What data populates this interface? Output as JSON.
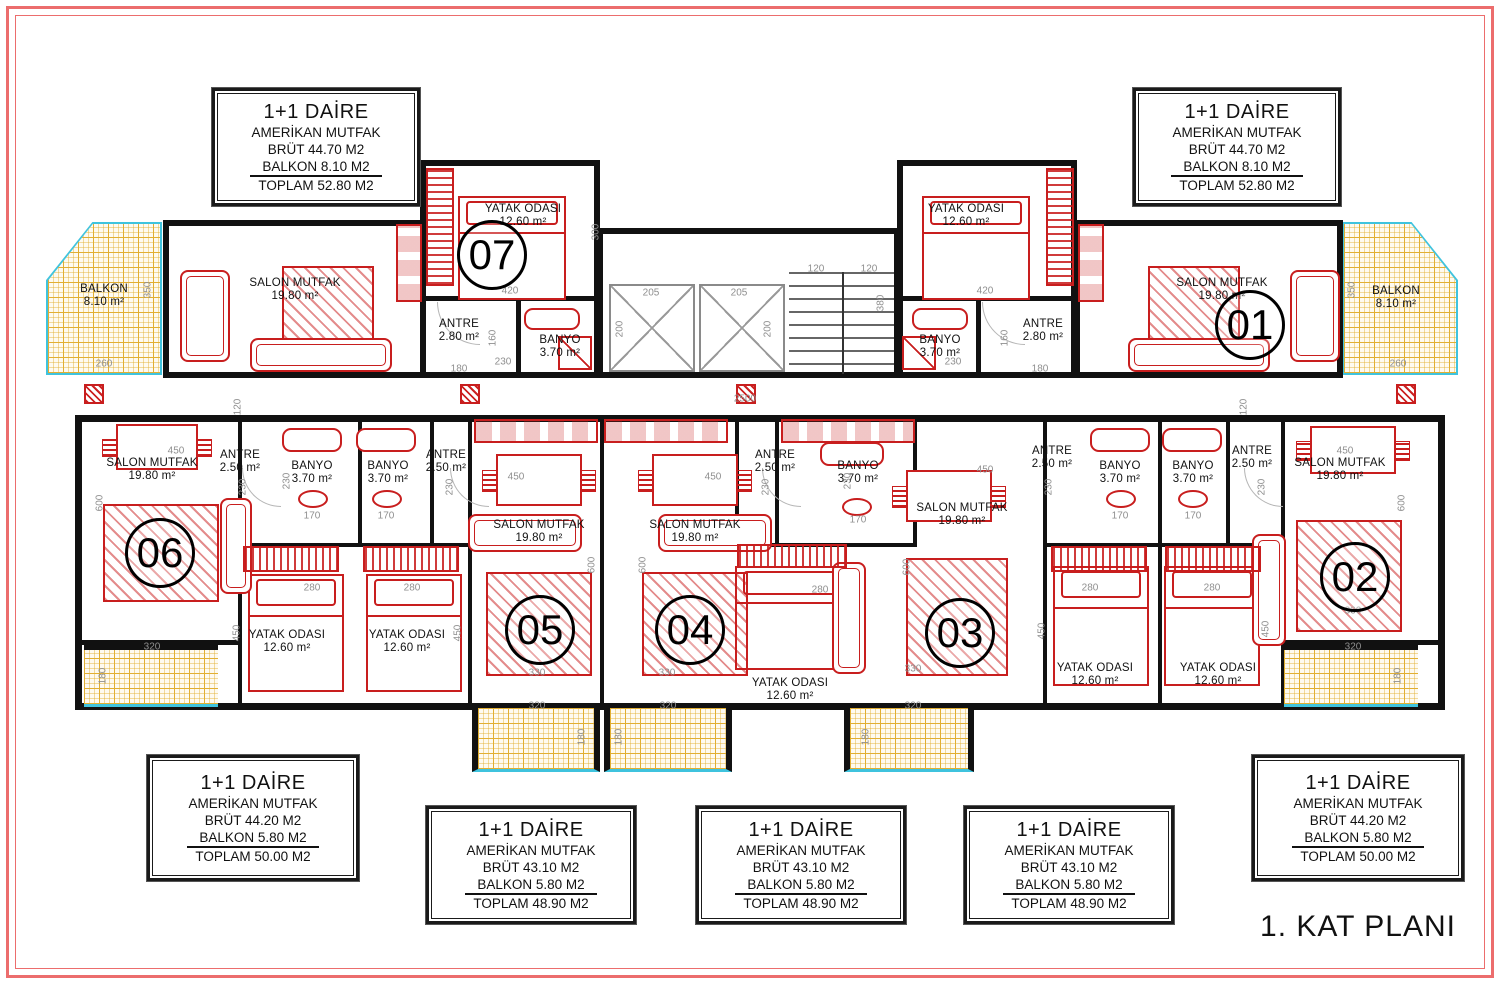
{
  "page": {
    "title": "1. KAT PLANI"
  },
  "colors": {
    "wall": "#111111",
    "furniture": "#c81e1e",
    "balcony_tile": "#e2b032",
    "balcony_edge": "#3fc3de",
    "dimension_text": "#8f8f8f",
    "frame": "#ec6d6d"
  },
  "units": [
    {
      "number": "01"
    },
    {
      "number": "02"
    },
    {
      "number": "03"
    },
    {
      "number": "04"
    },
    {
      "number": "05"
    },
    {
      "number": "06"
    },
    {
      "number": "07"
    }
  ],
  "info_boxes": [
    {
      "title": "1+1 DAİRE",
      "kitchen": "AMERİKAN MUTFAK",
      "brut": "BRÜT 44.70 M2",
      "balkon": "BALKON 8.10 M2",
      "toplam": "TOPLAM 52.80 M2"
    },
    {
      "title": "1+1 DAİRE",
      "kitchen": "AMERİKAN MUTFAK",
      "brut": "BRÜT 44.70 M2",
      "balkon": "BALKON 8.10 M2",
      "toplam": "TOPLAM 52.80 M2"
    },
    {
      "title": "1+1 DAİRE",
      "kitchen": "AMERİKAN MUTFAK",
      "brut": "BRÜT 44.20 M2",
      "balkon": "BALKON 5.80 M2",
      "toplam": "TOPLAM 50.00 M2"
    },
    {
      "title": "1+1 DAİRE",
      "kitchen": "AMERİKAN MUTFAK",
      "brut": "BRÜT 43.10 M2",
      "balkon": "BALKON 5.80 M2",
      "toplam": "TOPLAM 48.90 M2"
    },
    {
      "title": "1+1 DAİRE",
      "kitchen": "AMERİKAN MUTFAK",
      "brut": "BRÜT 43.10 M2",
      "balkon": "BALKON 5.80 M2",
      "toplam": "TOPLAM 48.90 M2"
    },
    {
      "title": "1+1 DAİRE",
      "kitchen": "AMERİKAN MUTFAK",
      "brut": "BRÜT 43.10 M2",
      "balkon": "BALKON 5.80 M2",
      "toplam": "TOPLAM 48.90 M2"
    },
    {
      "title": "1+1 DAİRE",
      "kitchen": "AMERİKAN MUTFAK",
      "brut": "BRÜT 44.20 M2",
      "balkon": "BALKON 5.80 M2",
      "toplam": "TOPLAM 50.00 M2"
    }
  ],
  "room_labels": [
    {
      "n": "BALKON",
      "a": "8.10 m²",
      "x": 104,
      "y": 296
    },
    {
      "n": "SALON MUTFAK",
      "a": "19.80 m²",
      "x": 295,
      "y": 290
    },
    {
      "n": "YATAK ODASI",
      "a": "12.60 m²",
      "x": 523,
      "y": 216
    },
    {
      "n": "ANTRE",
      "a": "2.80 m²",
      "x": 459,
      "y": 331
    },
    {
      "n": "BANYO",
      "a": "3.70 m²",
      "x": 560,
      "y": 347
    },
    {
      "n": "YATAK ODASI",
      "a": "12.60 m²",
      "x": 966,
      "y": 216
    },
    {
      "n": "BANYO",
      "a": "3.70 m²",
      "x": 940,
      "y": 347
    },
    {
      "n": "ANTRE",
      "a": "2.80 m²",
      "x": 1043,
      "y": 331
    },
    {
      "n": "SALON MUTFAK",
      "a": "19.80 m²",
      "x": 1222,
      "y": 290
    },
    {
      "n": "BALKON",
      "a": "8.10 m²",
      "x": 1396,
      "y": 298
    },
    {
      "n": "SALON MUTFAK",
      "a": "19.80 m²",
      "x": 152,
      "y": 470
    },
    {
      "n": "ANTRE",
      "a": "2.50 m²",
      "x": 240,
      "y": 462
    },
    {
      "n": "BANYO",
      "a": "3.70 m²",
      "x": 312,
      "y": 473
    },
    {
      "n": "BANYO",
      "a": "3.70 m²",
      "x": 388,
      "y": 473
    },
    {
      "n": "ANTRE",
      "a": "2.50 m²",
      "x": 446,
      "y": 462
    },
    {
      "n": "SALON MUTFAK",
      "a": "19.80 m²",
      "x": 539,
      "y": 532
    },
    {
      "n": "SALON MUTFAK",
      "a": "19.80 m²",
      "x": 695,
      "y": 532
    },
    {
      "n": "ANTRE",
      "a": "2.50 m²",
      "x": 775,
      "y": 462
    },
    {
      "n": "BANYO",
      "a": "3.70 m²",
      "x": 858,
      "y": 473
    },
    {
      "n": "SALON MUTFAK",
      "a": "19.80 m²",
      "x": 962,
      "y": 515
    },
    {
      "n": "ANTRE",
      "a": "2.50 m²",
      "x": 1052,
      "y": 458
    },
    {
      "n": "BANYO",
      "a": "3.70 m²",
      "x": 1120,
      "y": 473
    },
    {
      "n": "BANYO",
      "a": "3.70 m²",
      "x": 1193,
      "y": 473
    },
    {
      "n": "ANTRE",
      "a": "2.50 m²",
      "x": 1252,
      "y": 458
    },
    {
      "n": "SALON MUTFAK",
      "a": "19.80 m²",
      "x": 1340,
      "y": 470
    },
    {
      "n": "YATAK ODASI",
      "a": "12.60 m²",
      "x": 287,
      "y": 642
    },
    {
      "n": "YATAK ODASI",
      "a": "12.60 m²",
      "x": 407,
      "y": 642
    },
    {
      "n": "YATAK ODASI",
      "a": "12.60 m²",
      "x": 790,
      "y": 690
    },
    {
      "n": "YATAK ODASI",
      "a": "12.60 m²",
      "x": 1095,
      "y": 675
    },
    {
      "n": "YATAK ODASI",
      "a": "12.60 m²",
      "x": 1218,
      "y": 675
    }
  ],
  "dims": [
    [
      "350",
      148,
      290,
      1
    ],
    [
      "260",
      104,
      364,
      0
    ],
    [
      "300",
      596,
      232,
      1
    ],
    [
      "420",
      510,
      291,
      0
    ],
    [
      "160",
      493,
      338,
      1
    ],
    [
      "180",
      459,
      369,
      0
    ],
    [
      "230",
      503,
      362,
      0
    ],
    [
      "200",
      620,
      329,
      1
    ],
    [
      "205",
      651,
      293,
      0
    ],
    [
      "205",
      739,
      293,
      0
    ],
    [
      "200",
      768,
      329,
      1
    ],
    [
      "120",
      816,
      269,
      0
    ],
    [
      "120",
      869,
      269,
      0
    ],
    [
      "380",
      881,
      303,
      1
    ],
    [
      "420",
      985,
      291,
      0
    ],
    [
      "160",
      1005,
      338,
      1
    ],
    [
      "230",
      953,
      362,
      0
    ],
    [
      "180",
      1040,
      369,
      0
    ],
    [
      "350",
      1352,
      290,
      1
    ],
    [
      "260",
      1398,
      364,
      0
    ],
    [
      "2500",
      745,
      399,
      0
    ],
    [
      "120",
      238,
      407,
      1
    ],
    [
      "120",
      1244,
      407,
      1
    ],
    [
      "450",
      176,
      451,
      0
    ],
    [
      "230",
      243,
      487,
      1
    ],
    [
      "230",
      287,
      481,
      1
    ],
    [
      "170",
      312,
      516,
      0
    ],
    [
      "170",
      386,
      516,
      0
    ],
    [
      "230",
      450,
      487,
      1
    ],
    [
      "450",
      516,
      477,
      0
    ],
    [
      "600",
      100,
      503,
      1
    ],
    [
      "600",
      592,
      565,
      1
    ],
    [
      "600",
      643,
      565,
      1
    ],
    [
      "450",
      713,
      477,
      0
    ],
    [
      "230",
      766,
      487,
      1
    ],
    [
      "230",
      848,
      481,
      1
    ],
    [
      "170",
      858,
      520,
      0
    ],
    [
      "450",
      985,
      470,
      0
    ],
    [
      "600",
      907,
      567,
      1
    ],
    [
      "230",
      1049,
      487,
      1
    ],
    [
      "170",
      1120,
      516,
      0
    ],
    [
      "170",
      1193,
      516,
      0
    ],
    [
      "230",
      1262,
      487,
      1
    ],
    [
      "450",
      1345,
      451,
      0
    ],
    [
      "600",
      1402,
      503,
      1
    ],
    [
      "280",
      312,
      588,
      0
    ],
    [
      "280",
      412,
      588,
      0
    ],
    [
      "450",
      237,
      633,
      1
    ],
    [
      "450",
      458,
      633,
      1
    ],
    [
      "280",
      820,
      590,
      0
    ],
    [
      "280",
      1090,
      588,
      0
    ],
    [
      "280",
      1212,
      588,
      0
    ],
    [
      "450",
      1042,
      631,
      1
    ],
    [
      "450",
      1266,
      629,
      1
    ],
    [
      "320",
      152,
      647,
      0
    ],
    [
      "180",
      103,
      676,
      1
    ],
    [
      "330",
      537,
      673,
      0
    ],
    [
      "330",
      667,
      673,
      0
    ],
    [
      "320",
      537,
      706,
      0
    ],
    [
      "320",
      668,
      706,
      0
    ],
    [
      "180",
      582,
      737,
      1
    ],
    [
      "180",
      619,
      737,
      1
    ],
    [
      "330",
      913,
      669,
      0
    ],
    [
      "320",
      913,
      706,
      0
    ],
    [
      "180",
      866,
      737,
      1
    ],
    [
      "330",
      1353,
      611,
      0
    ],
    [
      "320",
      1353,
      647,
      0
    ],
    [
      "180",
      1398,
      676,
      1
    ]
  ]
}
